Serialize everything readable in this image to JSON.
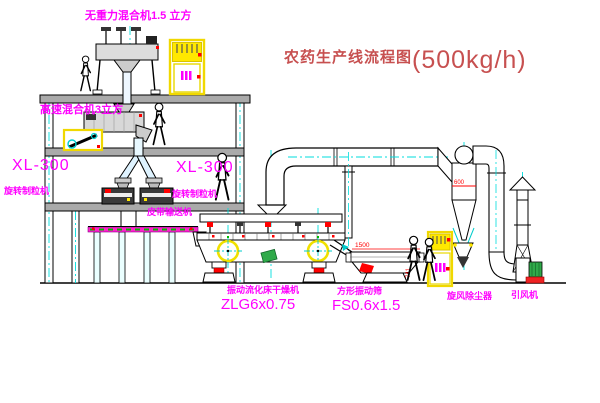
{
  "title": {
    "name": "农药生产线流程图",
    "capacity": "(500kg/h)"
  },
  "labels": {
    "weightless_mixer": "无重力混合机1.5 立方",
    "high_speed_mixer": "高速混合机3立方",
    "xl300_left": "XL-300",
    "rotary_granulator_left": "旋转制粒机",
    "xl300_mid": "XL-300",
    "rotary_granulator_mid": "旋转制粒机",
    "belt_conveyor": "皮带输送机",
    "dryer_name": "振动流化床干燥机",
    "dryer_model": "ZLG6x0.75",
    "sieve_name": "方形振动筛",
    "sieve_model": "FS0.6x1.5",
    "cyclone": "旋风除尘器",
    "fan": "引风机"
  },
  "dimensions": {
    "cyclone_outlet": "600",
    "sieve_length": "1500",
    "sieve_height": "741"
  },
  "colors": {
    "label_magenta": "#ff00ff",
    "title_red": "#c75050",
    "centerline_cyan": "#00dddd",
    "equipment_yellow": "#ffe800",
    "accent_red": "#ff0000",
    "motor_green": "#2faa4a",
    "belt_magenta": "#ff22cc"
  }
}
